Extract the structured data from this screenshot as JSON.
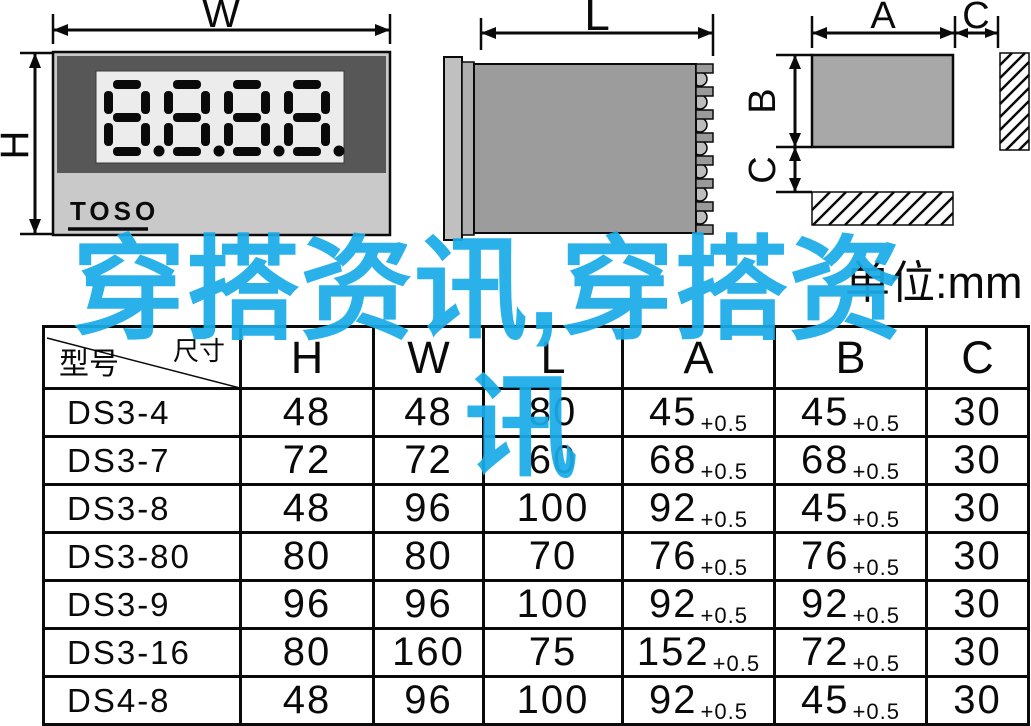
{
  "unit_label": "单位:mm",
  "watermark": {
    "full_text": "穿搭资讯,穿搭资讯",
    "line1": "穿搭资讯,穿搭资",
    "line2": "讯",
    "color": "#1AACE8"
  },
  "front_view": {
    "width_label": "W",
    "height_label": "H",
    "brand": "TOSO",
    "display_value": "8.8.8.8"
  },
  "side_view": {
    "length_label": "L"
  },
  "cutout_view": {
    "a_label": "A",
    "c_top_label": "C",
    "b_label": "B",
    "c_left_label": "C"
  },
  "table": {
    "corner": {
      "top_right": "尺寸",
      "bottom_left": "型号"
    },
    "headers": [
      "H",
      "W",
      "L",
      "A",
      "B",
      "C"
    ],
    "rows": [
      {
        "model": "DS3-4",
        "h": "48",
        "w": "48",
        "l": "80",
        "a": "45",
        "a_tol": "+0.5",
        "b": "45",
        "b_tol": "+0.5",
        "c": "30"
      },
      {
        "model": "DS3-7",
        "h": "72",
        "w": "72",
        "l": "60",
        "a": "68",
        "a_tol": "+0.5",
        "b": "68",
        "b_tol": "+0.5",
        "c": "30"
      },
      {
        "model": "DS3-8",
        "h": "48",
        "w": "96",
        "l": "100",
        "a": "92",
        "a_tol": "+0.5",
        "b": "45",
        "b_tol": "+0.5",
        "c": "30"
      },
      {
        "model": "DS3-80",
        "h": "80",
        "w": "80",
        "l": "70",
        "a": "76",
        "a_tol": "+0.5",
        "b": "76",
        "b_tol": "+0.5",
        "c": "30"
      },
      {
        "model": "DS3-9",
        "h": "96",
        "w": "96",
        "l": "100",
        "a": "92",
        "a_tol": "+0.5",
        "b": "92",
        "b_tol": "+0.5",
        "c": "30"
      },
      {
        "model": "DS3-16",
        "h": "80",
        "w": "160",
        "l": "75",
        "a": "152",
        "a_tol": "+0.5",
        "b": "72",
        "b_tol": "+0.5",
        "c": "30"
      },
      {
        "model": "DS4-8",
        "h": "48",
        "w": "96",
        "l": "100",
        "a": "92",
        "a_tol": "+0.5",
        "b": "45",
        "b_tol": "+0.5",
        "c": "30"
      }
    ]
  }
}
